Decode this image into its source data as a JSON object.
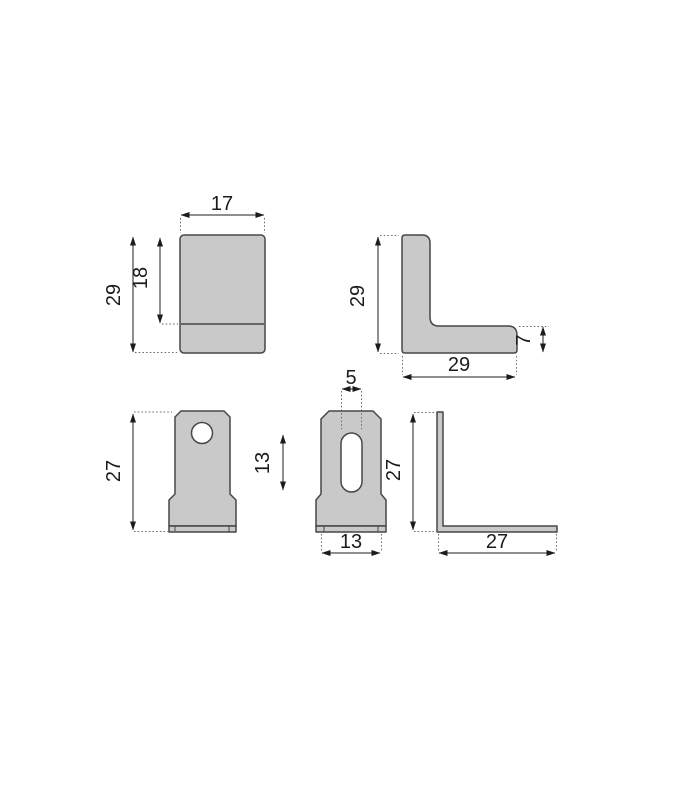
{
  "drawing": {
    "type": "technical-dimension-drawing",
    "part": "L-shaped angle bracket, five orthographic views",
    "colors": {
      "background": "#ffffff",
      "part_fill": "#c9c9c9",
      "outline": "#474747",
      "dimension_lines": "#1c1c1c"
    },
    "dims": {
      "top_front_width": "17",
      "top_front_upper_height": "18",
      "top_front_height": "29",
      "top_side_height": "29",
      "top_side_width": "29",
      "top_side_thickness": "7",
      "bottom_front_height": "27",
      "slot_width": "5",
      "slot_length": "13",
      "bottom_front_width": "13",
      "bottom_side_height": "27",
      "bottom_side_width": "27"
    }
  }
}
